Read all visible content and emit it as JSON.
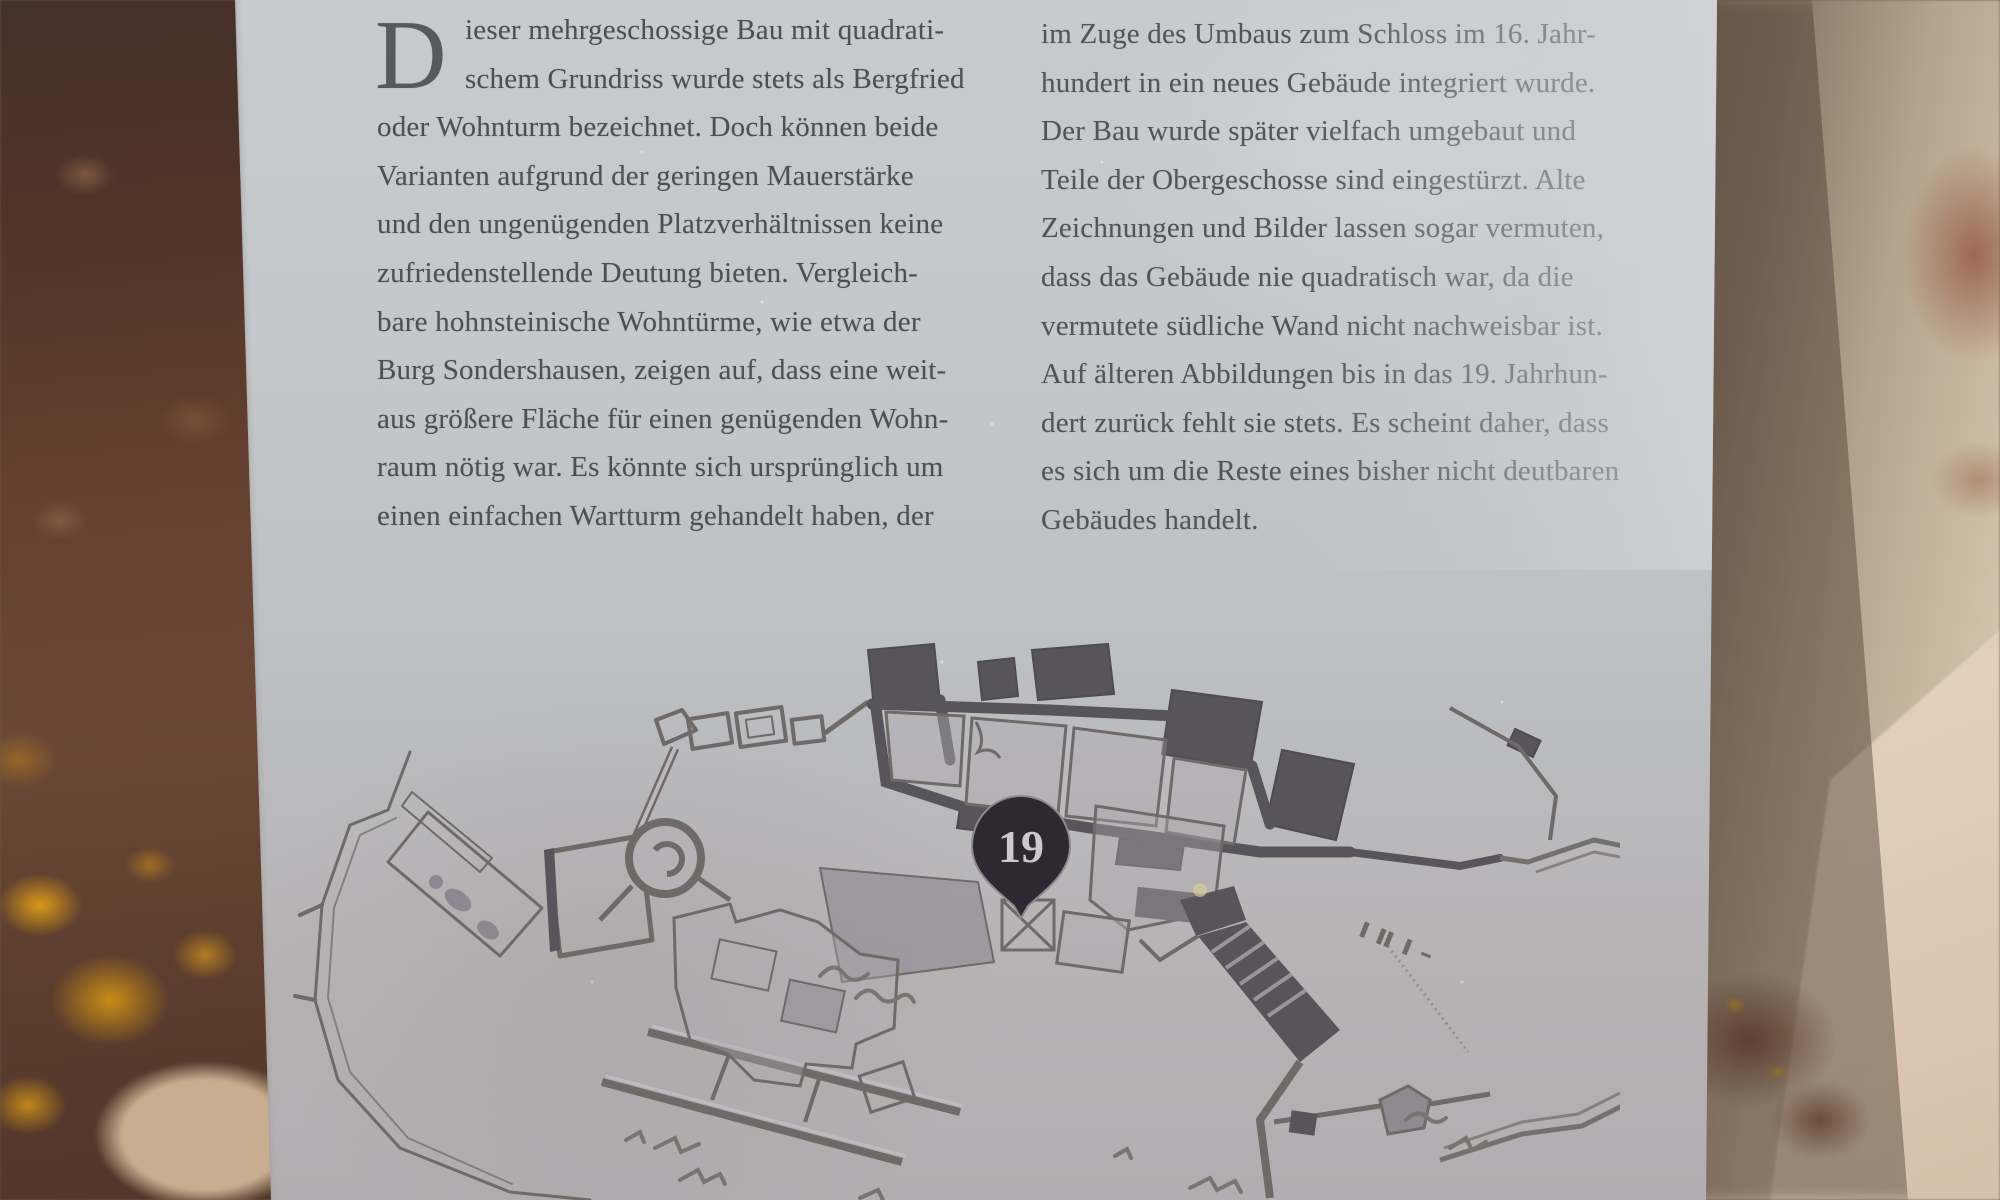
{
  "plaque": {
    "drop_cap": "D",
    "left_column": {
      "lines": [
        "ieser mehrgeschossige Bau mit quadrati-",
        "schem Grundriss wurde stets als Bergfried",
        "oder Wohnturm bezeichnet. Doch können beide",
        "Varianten aufgrund der geringen Mauerstärke",
        "und den ungenügenden Platzverhältnissen keine",
        "zufriedenstellende Deutung bieten. Vergleich-",
        "bare hohnsteinische Wohntürme, wie etwa der",
        "Burg Sondershausen, zeigen auf, dass eine weit-",
        "aus größere Fläche für einen genügenden Wohn-",
        "raum nötig war. Es könnte sich ursprünglich um",
        "einen einfachen Wartturm gehandelt haben, der"
      ]
    },
    "right_column": {
      "lines": [
        "im Zuge des Umbaus zum Schloss im 16. Jahr-",
        "hundert in ein neues Gebäude integriert wurde.",
        "Der Bau wurde später vielfach umgebaut und",
        "Teile der Obergeschosse sind eingestürzt. Alte",
        "Zeichnungen und Bilder lassen sogar vermuten,",
        "dass das Gebäude nie quadratisch war, da die",
        "vermutete südliche Wand nicht nachweisbar ist.",
        "Auf älteren Abbildungen bis in das 19. Jahrhun-",
        "dert zurück fehlt sie stets. Es scheint daher, dass",
        "es sich um die Reste eines bisher nicht deutbaren",
        "Gebäudes handelt."
      ]
    },
    "map": {
      "marker_label": "19"
    },
    "colors": {
      "plate": "#c3c7cb",
      "text": "#4f4e55",
      "map_line": "#6f6a67",
      "map_dark_fill": "#57545b",
      "marker_fill": "#2c2932",
      "marker_text": "#cbc8d0",
      "stone_left": "#5d3b2c",
      "lichen": "#d89a16",
      "stone_right_shadow": "#6e6053",
      "stone_right_light": "#d8cab4"
    }
  }
}
